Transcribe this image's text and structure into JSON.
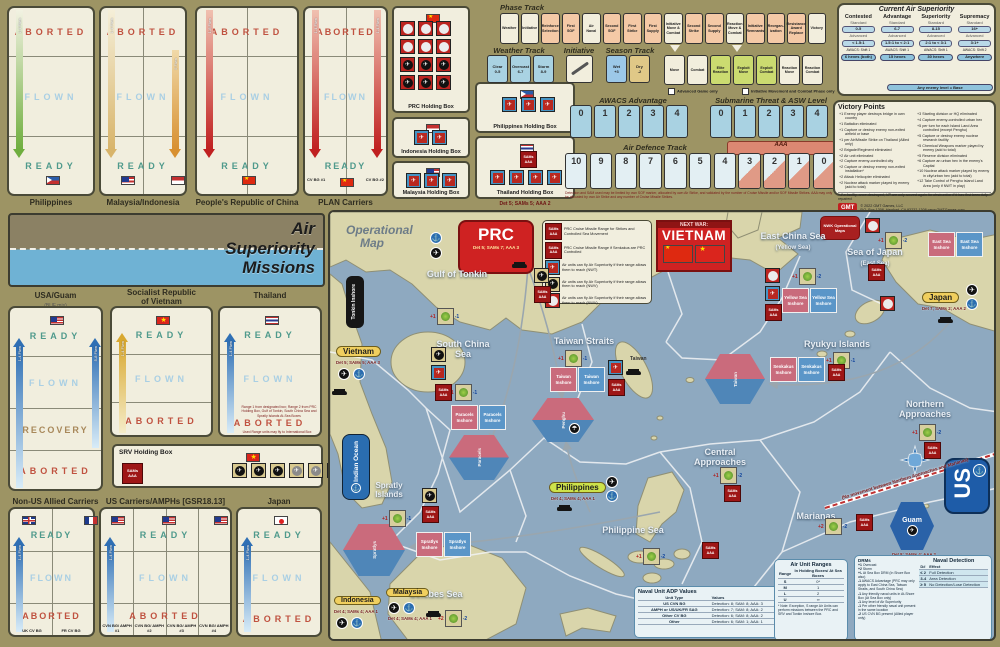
{
  "top_left_boxes": [
    {
      "label": "Philippines",
      "zones": [
        "ABORTED",
        "FLOWN",
        "READY"
      ],
      "arrows": [
        "1-4 Flwn",
        "5 Flwn"
      ]
    },
    {
      "label": "Malaysia/Indonesia",
      "zones": [
        "ABORTED",
        "FLOWN",
        "READY"
      ],
      "arrows": [
        "1-4 Flwn",
        "5 Flwn"
      ]
    },
    {
      "label": "People's Republic of China",
      "zones": [
        "ABORTED",
        "FLOWN",
        "READY"
      ],
      "arrows": [
        "1-8 Flwn"
      ]
    },
    {
      "label": "PLAN Carriers",
      "zones": [
        "ABORTED",
        "FLOWN",
        "READY"
      ],
      "arrows": [
        "1-4 Flwn",
        "1-4 Flwn"
      ],
      "cols": [
        "CV BG #1",
        "CV BG #2"
      ]
    }
  ],
  "holding_boxes": {
    "prc": {
      "label": "PRC Holding Box"
    },
    "philippines": {
      "label": "Philippines Holding Box"
    },
    "indonesia": {
      "label": "Indonesia Holding Box"
    },
    "malaysia": {
      "label": "Malaysia Holding Box"
    },
    "thailand": {
      "label": "Thailand Holding Box",
      "note": "Det 5; SAMs 5; AAA 2"
    },
    "srv": {
      "label": "SRV Holding Box"
    }
  },
  "phase_track": {
    "title": "Phase Track",
    "phases": [
      {
        "label": "Weather",
        "cls": "ph-cream"
      },
      {
        "label": "Initiative",
        "cls": "ph-cream"
      },
      {
        "label": "Reinforce Selection",
        "cls": "ph-peach"
      },
      {
        "label": "First SOF",
        "cls": "ph-peach"
      },
      {
        "label": "Air Naval",
        "cls": "ph-cream"
      },
      {
        "label": "Second SOF",
        "cls": "ph-peach"
      },
      {
        "label": "First Strike",
        "cls": "ph-peach"
      },
      {
        "label": "First Supply",
        "cls": "ph-peach"
      },
      {
        "label": "Initiative Move & Combat",
        "cls": "ph-cream"
      },
      {
        "label": "Second Strike",
        "cls": "ph-peach"
      },
      {
        "label": "Second Supply",
        "cls": "ph-peach"
      },
      {
        "label": "Reaction Move & Combat",
        "cls": "ph-cream"
      },
      {
        "label": "Initiative Remnants",
        "cls": "ph-peach"
      },
      {
        "label": "Reorgan- ization",
        "cls": "ph-peach"
      },
      {
        "label": "Resistance Award Replace",
        "cls": "ph-peach"
      },
      {
        "label": "Victory",
        "cls": "ph-cream"
      }
    ]
  },
  "segments": {
    "cells": [
      {
        "label": "Move",
        "cls": "ph-cream"
      },
      {
        "label": "Combat",
        "cls": "ph-cream"
      },
      {
        "label": "Elite Reaction",
        "cls": "ph-green"
      },
      {
        "label": "Exploit Move",
        "cls": "ph-green"
      },
      {
        "label": "Exploit Combat",
        "cls": "ph-green"
      },
      {
        "label": "Reaction Move",
        "cls": "ph-cream"
      },
      {
        "label": "Reaction Combat",
        "cls": "ph-cream"
      }
    ],
    "notes": [
      "Advanced Game only",
      "Initiative Movement and Combat Phase only"
    ]
  },
  "weather_track": {
    "title": "Weather Track",
    "cells": [
      {
        "name": "Clear",
        "range": "0-5"
      },
      {
        "name": "Overcast",
        "range": "6-7"
      },
      {
        "name": "Storm",
        "range": "8-9"
      }
    ]
  },
  "initiative": {
    "title": "Initiative"
  },
  "season_track": {
    "title": "Season Track",
    "cells": [
      {
        "name": "Wet",
        "mod": "+3"
      },
      {
        "name": "Dry",
        "mod": "-2"
      }
    ]
  },
  "awacs": {
    "title": "AWACS Advantage",
    "cells": [
      "0",
      "1",
      "2",
      "3",
      "4"
    ]
  },
  "submarine": {
    "title": "Submarine Threat & ASW Level",
    "cells": [
      "0",
      "1",
      "2",
      "3",
      "4"
    ]
  },
  "air_defence": {
    "title": "Air Defence Track",
    "aaa_label": "AAA",
    "cells": [
      {
        "v": "10",
        "cls": ""
      },
      {
        "v": "9",
        "cls": ""
      },
      {
        "v": "8",
        "cls": ""
      },
      {
        "v": "7",
        "cls": ""
      },
      {
        "v": "6",
        "cls": ""
      },
      {
        "v": "5",
        "cls": ""
      },
      {
        "v": "4",
        "cls": ""
      },
      {
        "v": "3",
        "cls": "aaa"
      },
      {
        "v": "2",
        "cls": "aaa"
      },
      {
        "v": "1",
        "cls": "aaa"
      },
      {
        "v": "0",
        "cls": "aaa"
      }
    ],
    "note": "Detection and SAM used may be limited by own SOF marker, allocated by own Air Strike, and validated by the number of Cruise Missile and/or SOF Missile Strikes. AAA may only be allocated by own Air Strike and any number of Cruise Missile Strikes."
  },
  "air_superiority": {
    "title": "Current Air Superiority",
    "standard_label": "Standard",
    "advanced_label": "Advanced",
    "columns": [
      {
        "name": "Contested",
        "standard": "0-5",
        "advanced": "< 1.5:1",
        "awacs": "AWACS: Shift 1",
        "range": "6 hexes (both)"
      },
      {
        "name": "Advantage",
        "standard": "6-7",
        "advanced": "1.5:1 to < 2:1",
        "awacs": "AWACS: Shift 1",
        "range": "15 hexes"
      },
      {
        "name": "Superiority",
        "standard": "8-15",
        "advanced": "2:1 to < 3:1",
        "awacs": "AWACS: Shift 1",
        "range": "30 hexes"
      },
      {
        "name": "Supremacy",
        "standard": "16+",
        "advanced": "3:1+",
        "awacs": "AWACS: Shift 2",
        "range": "Anywhere"
      }
    ],
    "footer": "Any enemy level = Base"
  },
  "victory_points": {
    "title": "Victory Points",
    "left": [
      "+1  Enemy player destroys bridge in own country",
      "+1  Battalion eliminated",
      "+1  Capture or destroy enemy non-exited airfield or base",
      "+1  per Air/Missile Strike on Thailand (Allied only)",
      "+2  Brigade/Regiment eliminated",
      "+2  Air unit eliminated",
      "+2  Capture enemy-controlled city",
      "+2  Capture or destroy enemy non-exited installation*",
      "+2  Attack Helicopter eliminated",
      "+2  Nuclear attack marker played by enemy (add to total)"
    ],
    "right": [
      "+3  Starting division or HQ eliminated",
      "+4  Capture enemy-controlled urban hex",
      "+5  per turn for each Island Land Area controlled (except Penghu)",
      "+5  Capture or destroy enemy nuclear research facility",
      "+5  Chemical Weapons marker played by enemy (add to total)",
      "+5  Reserve division eliminated",
      "+6  Capture an urban hex in the enemy's Capital",
      "+10 Nuclear attack marker played by enemy in city/urban hex (add to total)",
      "+12 Take Control of Penghu Island Land Area (only if NWT in play)"
    ],
    "footnote": "* If a facility, once destroyed, VP are only scored again for destruction if it has first been fully repaired.",
    "logo": "GMT",
    "copyright": [
      "© 2022 GMT Games, LLC",
      "P.O. Box 1308, Hanford, CA 93232-1308",
      "www.GMTGames.com"
    ]
  },
  "banner": {
    "line1": "Air",
    "line2": "Superiority",
    "line3": "Missions"
  },
  "mid_boxes": {
    "usa": {
      "title": "USA/Guam",
      "subtitle": "(BUF mis)",
      "zones": [
        "READY",
        "FLOWN",
        "RECOVERY",
        "ABORTED"
      ],
      "arrows": [
        "1-4 Flwn",
        "5-8 Flwn"
      ]
    },
    "srv": {
      "title": "Socialist Republic",
      "title2": "of Vietnam",
      "zones": [
        "READY",
        "FLOWN",
        "ABORTED"
      ],
      "arrows": [
        "1-4 Flwn"
      ]
    },
    "thailand": {
      "title": "Thailand",
      "zones": [
        "READY",
        "FLOWN",
        "ABORTED"
      ],
      "arrows": [
        "1-4 Flwn"
      ],
      "note": "Range 1 from designated box; Range 2 from PRC Holding Box, Gulf of Tonkin, South China Sea and Spratly Islands At-Sea Boxes",
      "note2": "Used Range units may fly to International Box"
    }
  },
  "bottom_boxes": {
    "nonus": {
      "title": "Non-US Allied Carriers",
      "zones": [
        "READY",
        "FLOWN",
        "ABORTED"
      ],
      "cols": [
        "UK CV BG",
        "FR CV BG"
      ],
      "arrows": [
        "1-4 Flwn"
      ]
    },
    "us": {
      "title": "US Carriers/AMPHs [GSR18.13]",
      "zones": [
        "READY",
        "FLOWN",
        "ABORTED"
      ],
      "cols": [
        "CVN BG/ AMPH #1",
        "CVN BG/ AMPH #2",
        "CVN BG/ AMPH #3",
        "CVN BG/ AMPH #4"
      ],
      "arrows": [
        "1-4 Flwn"
      ]
    },
    "japan": {
      "title": "Japan",
      "zones": [
        "READY",
        "FLOWN",
        "ABORTED"
      ],
      "arrows": [
        "1-4 Flwn"
      ]
    }
  },
  "map": {
    "watermark1": "Operational",
    "watermark2": "Map",
    "title": {
      "kicker": "NEXT WAR:",
      "name": "VIETNAM"
    },
    "ops_box": "NWK Operational Maps",
    "prc_box": {
      "name": "PRC",
      "stats": "Det 5; SAMs 7; AAA 3"
    },
    "pills": {
      "vietnam": {
        "name": "Vietnam",
        "stats": "Det 5; SAMs 5; AAA 3"
      },
      "philippines": {
        "name": "Philippines",
        "stats": "Det 4; SAMs 4; AAA 1"
      },
      "japan": {
        "name": "Japan",
        "stats": "Det 7; SAMs 2; AAA 2"
      },
      "indonesia": {
        "name": "Indonesia",
        "stats": "Det 4; SAMs 4; AAA 1"
      },
      "malaysia": {
        "name": "Malaysia",
        "stats": "Det 4; SAMs 4; AAA 1"
      }
    },
    "guam": {
      "name": "Guam",
      "stats": "Det 8; SAMs 4; AAA 2"
    },
    "us_label": "US",
    "seas": {
      "tonkin": "Gulf of Tonkin",
      "scs": "South China Sea",
      "straits": "Taiwan Straits",
      "ecs": "East China Sea",
      "ecs2": "(Yellow Sea)",
      "soj": "Sea of Japan",
      "soj2": "(East Sea)",
      "ryukyu": "Ryukyu Islands",
      "northern": "Northern Approaches",
      "central": "Central Approaches",
      "philsea": "Philippine Sea",
      "celebes": "Celebes Sea",
      "spratly": "Spratly Islands",
      "marianas": "Marianas",
      "indian": "Indian Ocean",
      "taiwan": "Taiwan",
      "tonkin_inshore": "Tonkin Inshore"
    },
    "inshore": {
      "taiwan": "Taiwan Inshore",
      "paracels": "Paracels Inshore",
      "spratlys": "Spratlys Inshore",
      "yellow": "Yellow Sea Inshore",
      "eastsea": "East Sea Inshore",
      "senkakus": "Senkakus Inshore"
    },
    "hexes": {
      "penghu": "Penghu",
      "taiwan": "Taiwan",
      "paracels": "Paracels",
      "spratlys": "Spratlys"
    },
    "sam_label_1": "SAMs",
    "sam_label_2": "AAA",
    "det": {
      "tonkin": [
        "+1",
        "-1"
      ],
      "scs": [
        "+1",
        "-1"
      ],
      "straits": [
        "+1",
        "-1"
      ],
      "ecs": [
        "+1",
        "-2"
      ],
      "soj": [
        "+1",
        "-2"
      ],
      "ryukyu": [
        "+1",
        "-1"
      ],
      "northern": [
        "+1",
        "-2"
      ],
      "central": [
        "+1",
        "-2"
      ],
      "philsea": [
        "+1",
        "-2"
      ],
      "celebes": [
        "+2",
        "-2"
      ],
      "marianas": [
        "+2",
        "-2"
      ],
      "spratly": [
        "+1",
        "-1"
      ]
    },
    "legend": [
      {
        "cls": "sams",
        "text": "PRC Cruise Missile Range for Strikes and Controlled Sea Movement"
      },
      {
        "cls": "sams",
        "text": "PRC Cruise Missile Range if Senkakus are PRC Controlled"
      },
      {
        "cls": "blue",
        "text": "Air units can fly Air Superiority if their range allows them to reach (NWT)"
      },
      {
        "cls": "tan",
        "text": "Air units can fly Air Superiority if their range allows them to reach (NWV)"
      },
      {
        "cls": "red",
        "text": "Air units can fly Air Superiority if their range allows them to reach (NWV)"
      }
    ],
    "no_move_note": "(No movement between Northern Approaches and Marianas)",
    "adp_table": {
      "title": "Naval Unit ADP Values",
      "col1": "Unit Type",
      "col2": "Values",
      "rows": [
        [
          "US CVN BG",
          "Detection: 8; SAM: 8; AAA: 3"
        ],
        [
          "AMPH or US/UK/FR SAG",
          "Detection: 7; SAM: 8; AAA: 2"
        ],
        [
          "Other CV BG",
          "Detection: 6; SAM: 8; AAA: 2"
        ],
        [
          "Other",
          "Detection: 6; SAM: 1; AAA: 1"
        ]
      ]
    },
    "range_table": {
      "title": "Air Unit Ranges",
      "col1": "Range",
      "col2": "In Holding Boxes/ At Sea Boxes",
      "rows": [
        [
          "S",
          "0*"
        ],
        [
          "M",
          "1"
        ],
        [
          "L",
          "2"
        ],
        [
          "U",
          "∞"
        ]
      ],
      "note": "* Note: Exception, S range Air Units can perform missions between the PRC and SRV and Tonkin Inshore Box."
    },
    "detection_panel": {
      "title": "Naval Detection",
      "drms_title": "DRMs",
      "drms": [
        [
          "+1",
          "Overcast"
        ],
        [
          "+2",
          "Storm"
        ],
        [
          "+/-",
          "At Sea Box DRM (In Shore Box also)"
        ],
        [
          "-1",
          "AWACS Advantage (PRC may only apply to East China Sea, Taiwan Straits, and South China Sea)"
        ],
        [
          "-1",
          "Any friendly naval units in At-Shore Box (At Sea Box only)"
        ],
        [
          "-1",
          "Any level of Air Superiority"
        ],
        [
          "-1",
          "Per other friendly naval unit present in the same location"
        ],
        [
          "-2",
          "US CVN BG present (Allied player only)"
        ]
      ],
      "col1": "D#",
      "col2": "Effect",
      "rows": [
        [
          "≤ 2",
          "Full Detection"
        ],
        [
          "3-4",
          "Area Detection"
        ],
        [
          "≥ 5",
          "No Detection/Lose Detection"
        ]
      ]
    }
  }
}
